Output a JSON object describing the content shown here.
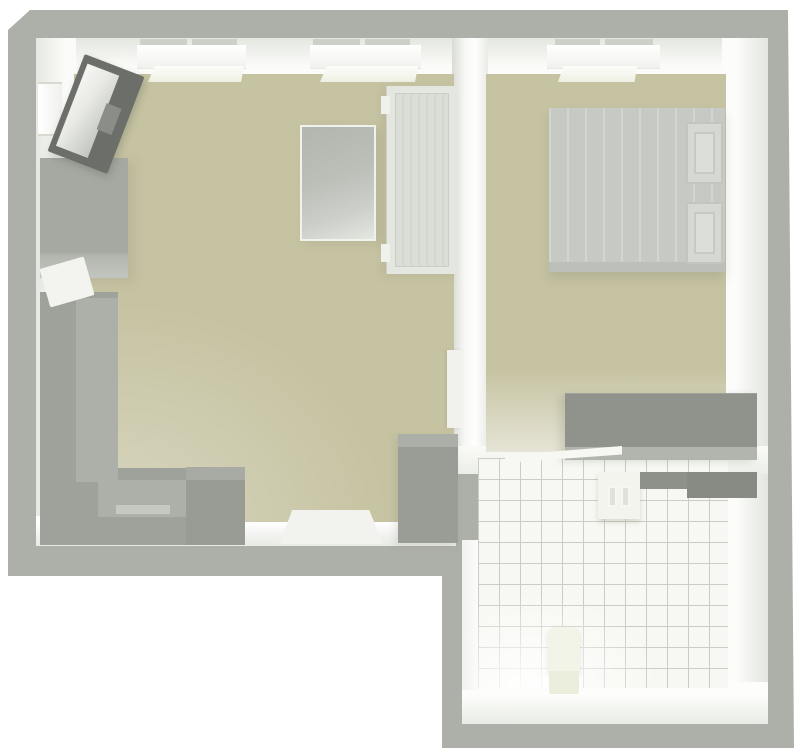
{
  "app": {
    "name": "floor-plan-render",
    "view": "top-down-3d",
    "text_content": "none"
  },
  "colors": {
    "background": "#ffffff",
    "wall": "#adb0a8",
    "wall_face": "#f6f7f3",
    "floor": "#c6c3a2",
    "tile_bg": "#f7f8f3",
    "tile_line": "#c9cdc2",
    "sofa": "#9fa29b",
    "sofa_seat": "#adb0a8",
    "gray_furniture": "#9a9d95",
    "tv_frame": "#6c6f69",
    "tv_screen": "#e9eae6",
    "bed": "#c7c9c5",
    "pillow": "#d6d8d4",
    "white_furniture": "#e4e6e0",
    "rug": "#f2f3ee",
    "counter": "#888b84",
    "sink": "#f3f4ee",
    "toilet": "#f3f4e8",
    "dresser": "#90938c"
  },
  "rooms": [
    {
      "name": "living-room",
      "floor": "beige",
      "windows_top_wall": 2,
      "windows_left_wall": 1,
      "furniture": [
        "tv",
        "tv-stand",
        "corner-sofa",
        "sofa-throw",
        "coffee-table",
        "wardrobe",
        "storage-cabinet",
        "floor-rug",
        "interior-door"
      ]
    },
    {
      "name": "bedroom",
      "floor": "beige",
      "windows_top_wall": 1,
      "furniture": [
        "double-bed",
        "pillow-left",
        "pillow-right",
        "dresser",
        "door-panel"
      ]
    },
    {
      "name": "bathroom",
      "floor": "white-tile-grid",
      "windows_top_wall": 0,
      "furniture": [
        "wall-sink",
        "countertop",
        "toilet"
      ]
    }
  ]
}
